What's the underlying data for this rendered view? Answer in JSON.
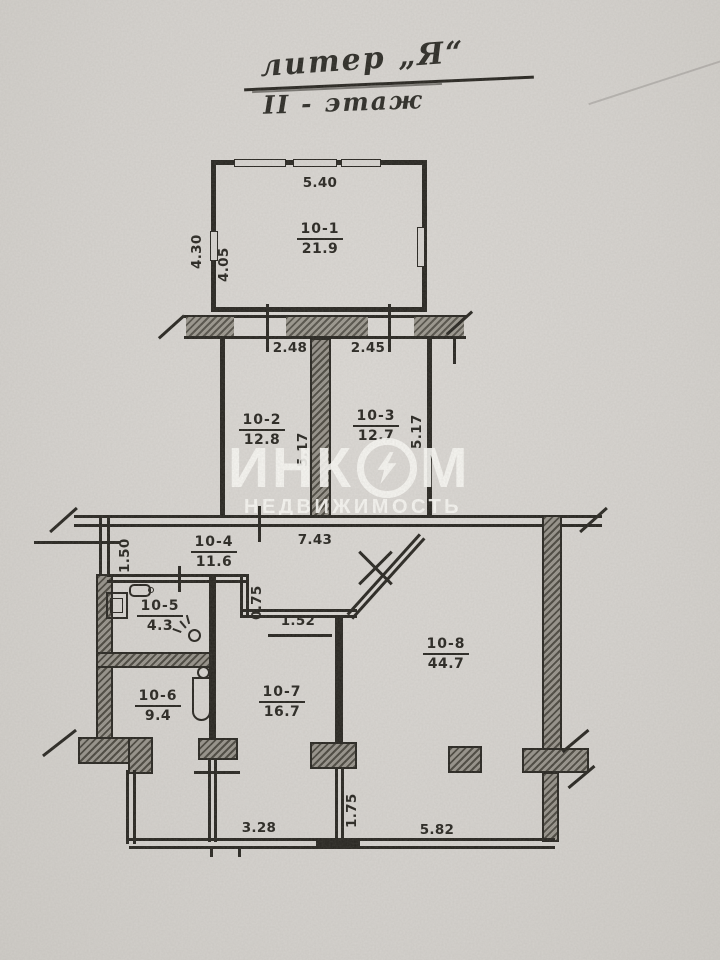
{
  "document": {
    "title_line1": "литер „Я“",
    "title_line2": "II - этаж"
  },
  "watermark": {
    "brand_left": "ИНК",
    "brand_right": "М",
    "subtitle": "НЕДВИЖИМОСТЬ"
  },
  "rooms": {
    "r10_1": {
      "num": "10-1",
      "area": "21.9"
    },
    "r10_2": {
      "num": "10-2",
      "area": "12.8"
    },
    "r10_3": {
      "num": "10-3",
      "area": "12.7"
    },
    "r10_4": {
      "num": "10-4",
      "area": "11.6"
    },
    "r10_5": {
      "num": "10-5",
      "area": "4.3"
    },
    "r10_6": {
      "num": "10-6",
      "area": "9.4"
    },
    "r10_7": {
      "num": "10-7",
      "area": "16.7"
    },
    "r10_8": {
      "num": "10-8",
      "area": "44.7"
    }
  },
  "dimensions": {
    "room1_width": "5.40",
    "room1_height_outer": "4.30",
    "room1_height_inner": "4.05",
    "opening_left": "2.48",
    "opening_right": "2.45",
    "room2_height": "5.17",
    "room3_height": "5.17",
    "corridor_width": "7.43",
    "corridor_left": "1.50",
    "step_depth": "0.75",
    "step_width": "1.52",
    "bottom_inner": "1.75",
    "bottom_left_span": "3.28",
    "bottom_right_span": "5.82"
  },
  "colors": {
    "paper": "#d8d5d1",
    "ink": "#26241f",
    "watermark": "#fbfaf6"
  }
}
